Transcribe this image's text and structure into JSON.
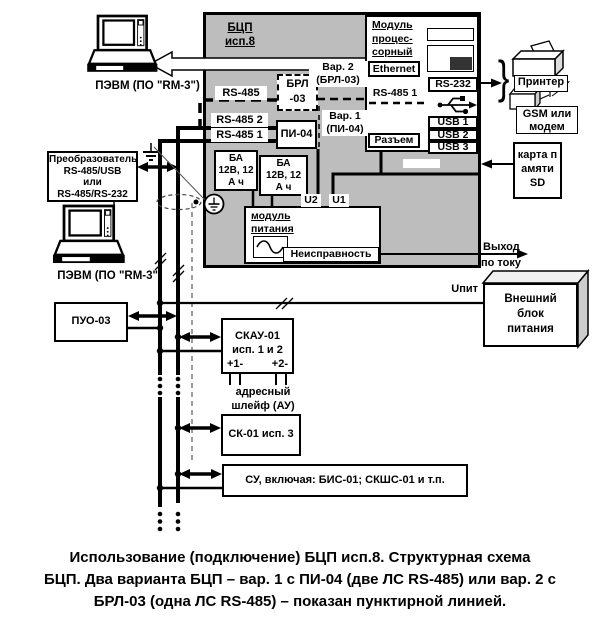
{
  "colors": {
    "panel_gray": "#bdbdbd",
    "line": "#000000",
    "background": "#ffffff"
  },
  "bcp": {
    "title_line1": "БЦП",
    "title_line2": "исп.8"
  },
  "processor_module": {
    "title_lines": [
      "Модуль",
      "процес-",
      "сорный"
    ],
    "ethernet": "Ethernet",
    "rs232": "RS-232",
    "rs485_1_dashed": "RS-485 1",
    "razem": "Разъем",
    "usb1": "USB 1",
    "usb2": "USB 2",
    "usb3": "USB 3"
  },
  "variants": {
    "var2_line1": "Вар. 2",
    "var2_line2": "(БРЛ-03)",
    "var1_line1": "Вар. 1",
    "var1_line2": "(ПИ-04)"
  },
  "brl": {
    "line1": "БРЛ",
    "line2": "-03"
  },
  "pi04": "ПИ-04",
  "rs485_labels": {
    "top": "RS-485",
    "line2": "RS-485 2",
    "line1": "RS-485 1"
  },
  "batteries": {
    "ba1": [
      "БА",
      "12В, 12",
      "А ч"
    ],
    "ba2": [
      "БА",
      "12В, 12",
      "А ч"
    ]
  },
  "power_module": {
    "title1": "модуль",
    "title2": "питания",
    "fault": "Неисправность",
    "u2": "U2",
    "u1": "U1"
  },
  "pc_top": {
    "label": "ПЭВМ (ПО \"RM-3\")"
  },
  "pc_bottom": {
    "label": "ПЭВМ (ПО \"RM-3\")"
  },
  "converter": {
    "lines": [
      "Преобразователь",
      "RS-485/USB",
      "или",
      "RS-485/RS-232"
    ]
  },
  "puo": "ПУО-03",
  "skau": {
    "line1": "СКАУ-01",
    "line2": "исп. 1 и 2",
    "t1": "+1-",
    "t2": "+2-",
    "loop1": "адресный",
    "loop2": "шлейф (АУ)"
  },
  "sk01": "СК-01 исп. 3",
  "su": "СУ, включая: БИС-01; СКШС-01 и т.п.",
  "printer_group": {
    "printer": "Принтер",
    "brace": "}"
  },
  "gsm": {
    "line1": "GSM или",
    "line2": "модем"
  },
  "sd_card": {
    "lines": [
      "карта п",
      "амяти",
      "SD"
    ]
  },
  "external_psu": {
    "lines": [
      "Внешний",
      "блок",
      "питания"
    ]
  },
  "outputs": {
    "current_out1": "Выход",
    "current_out2": "по току",
    "upit": "Uпит"
  },
  "icons": {
    "computer": "computer-icon",
    "printer": "printer-icon",
    "modem": "modem-icon",
    "antenna": "antenna-icon",
    "ground": "ground-icon",
    "functional_ground": "functional-ground-icon",
    "usb": "usb-trident-icon",
    "led": "led-icon",
    "sine": "ac-sine-icon"
  },
  "caption": {
    "lines": [
      "Использование (подключение) БЦП исп.8. Структурная схема",
      "БЦП. Два варианта БЦП – вар. 1 с ПИ-04 (две ЛС RS-485) или вар. 2 с",
      "БРЛ-03 (одна ЛС RS-485) – показан пунктирной линией."
    ]
  }
}
